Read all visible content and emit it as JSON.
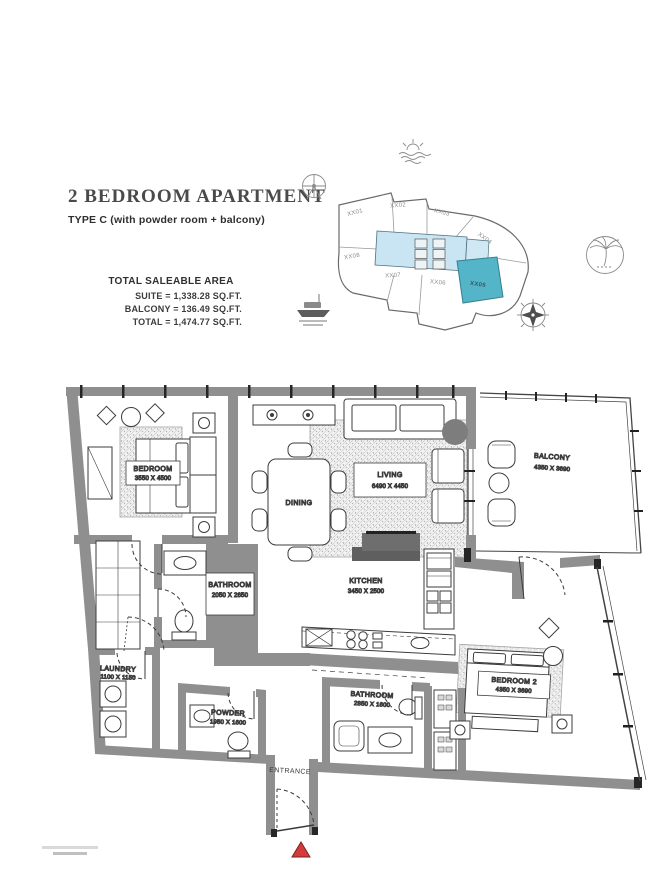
{
  "header": {
    "title": "2 BEDROOM APARTMENT",
    "subtitle": "TYPE C (with powder room + balcony)"
  },
  "area_summary": {
    "heading": "TOTAL SALEABLE AREA",
    "suite": "SUITE = 1,338.28 SQ.FT.",
    "balcony": "BALCONY = 136.49 SQ.FT.",
    "total": "TOTAL = 1,474.77 SQ.FT."
  },
  "key_plan": {
    "units": [
      "XX01",
      "XX02",
      "XX03",
      "XX04",
      "XX05",
      "XX06",
      "XX07",
      "XX08"
    ],
    "highlighted_unit": "XX05",
    "colors": {
      "highlight": "#54b4c8",
      "core": "#c9e4f2"
    },
    "icons": [
      "sea-icon",
      "ferris-wheel-icon",
      "palm-icon",
      "yacht-icon",
      "compass-icon"
    ]
  },
  "floor_plan": {
    "rooms": [
      {
        "name": "BEDROOM",
        "dims": "3550 X 4500"
      },
      {
        "name": "LIVING",
        "dims": "6490 X 4450"
      },
      {
        "name": "DINING",
        "dims": ""
      },
      {
        "name": "BALCONY",
        "dims": "4350 X 3690"
      },
      {
        "name": "KITCHEN",
        "dims": "3450 X 2500"
      },
      {
        "name": "BATHROOM",
        "dims": "2050 X 2650"
      },
      {
        "name": "LAUNDRY",
        "dims": "1100 X 1150"
      },
      {
        "name": "POWDER",
        "dims": "1950 X 1600"
      },
      {
        "name": "BATHROOM",
        "dims": "2850 X 1600"
      },
      {
        "name": "BEDROOM 2",
        "dims": "4350 X 3690"
      },
      {
        "name": "ENTRANCE",
        "dims": ""
      }
    ],
    "entrance_marker_color": "#d63b3b"
  }
}
